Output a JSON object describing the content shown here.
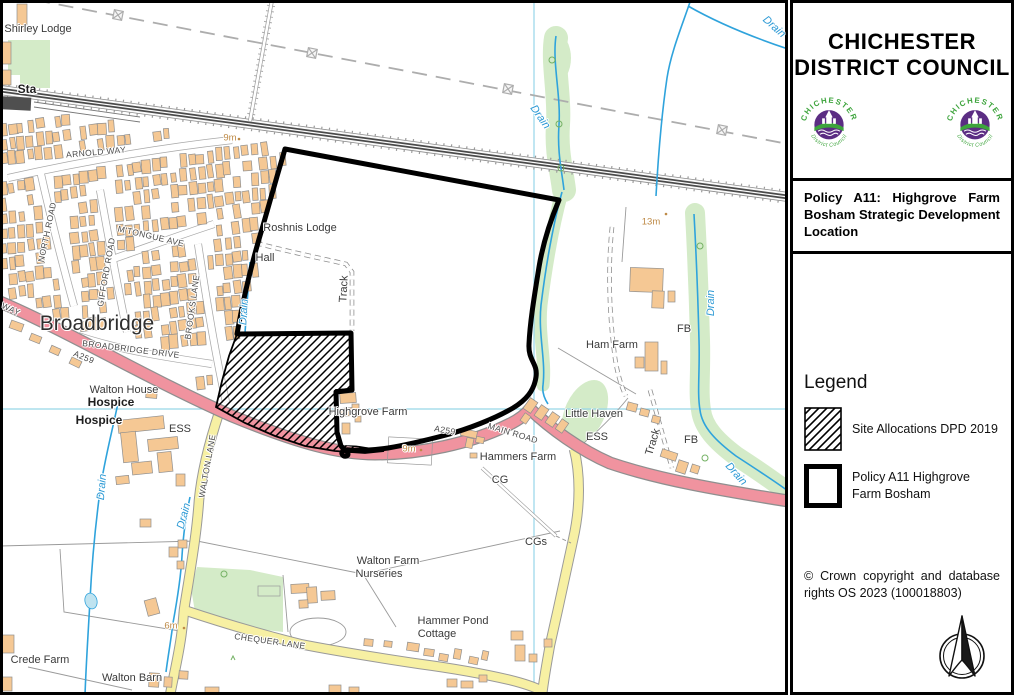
{
  "panel": {
    "title": "CHICHESTER DISTRICT COUNCIL",
    "logo": {
      "arc_top": "CHICHESTER",
      "arc_bottom": "District Council"
    },
    "policy_statement": "Policy A11: Highgrove Farm Bosham Strategic Development Location",
    "legend": {
      "heading": "Legend",
      "items": [
        {
          "id": "site-allocations",
          "swatch": "hatch",
          "label": "Site Allocations DPD 2019"
        },
        {
          "id": "policy-a11",
          "swatch": "thick-outline",
          "label": "Policy A11 Highgrove Farm Bosham"
        }
      ]
    },
    "copyright": "© Crown copyright and database rights OS 2023 (100018803)"
  },
  "map": {
    "colors": {
      "building": "#F5C894",
      "building_outline": "#8F8F8F",
      "a_road": "#F0939F",
      "minor_road": "#F7F0A3",
      "green": "#D4EBC8",
      "water": "#2FA3DC",
      "grid": "#97D6E8",
      "boundary": "#000000",
      "height_label": "#BE8A46"
    },
    "labels": [
      {
        "text": "Shirley Lodge",
        "x": 38,
        "y": 29,
        "r": 0,
        "s": "p"
      },
      {
        "text": "Sta",
        "x": 27,
        "y": 89,
        "r": 0,
        "s": "b"
      },
      {
        "text": "ARNOLD WAY",
        "x": 96,
        "y": 152,
        "r": -5,
        "s": "r"
      },
      {
        "text": "9m",
        "x": 230,
        "y": 138,
        "r": 0,
        "s": "h"
      },
      {
        "text": "NORTH ROAD",
        "x": 47,
        "y": 232,
        "r": -78,
        "s": "r"
      },
      {
        "text": "M'TONGUE AVE",
        "x": 151,
        "y": 236,
        "r": 13,
        "s": "r"
      },
      {
        "text": "GIFFORD ROAD",
        "x": 106,
        "y": 272,
        "r": -80,
        "s": "r"
      },
      {
        "text": "BROOKS LANE",
        "x": 192,
        "y": 307,
        "r": -82,
        "s": "r"
      },
      {
        "text": "Broadbridge",
        "x": 97,
        "y": 324,
        "r": 0,
        "s": "c"
      },
      {
        "text": "BROADBRIDGE DRIVE",
        "x": 131,
        "y": 349,
        "r": 7,
        "s": "r"
      },
      {
        "text": "A259",
        "x": 84,
        "y": 357,
        "r": 22,
        "s": "r"
      },
      {
        "text": "WAY",
        "x": 11,
        "y": 309,
        "r": 25,
        "s": "r"
      },
      {
        "text": "Roshnis Lodge",
        "x": 300,
        "y": 228,
        "r": 0,
        "s": "p"
      },
      {
        "text": "Hall",
        "x": 265,
        "y": 258,
        "r": 0,
        "s": "p"
      },
      {
        "text": "Track",
        "x": 344,
        "y": 289,
        "r": -87,
        "s": "p"
      },
      {
        "text": "Drain",
        "x": 244,
        "y": 312,
        "r": -87,
        "s": "w"
      },
      {
        "text": "13m",
        "x": 651,
        "y": 222,
        "r": 0,
        "s": "h"
      },
      {
        "text": "Drain",
        "x": 540,
        "y": 117,
        "r": 55,
        "s": "w"
      },
      {
        "text": "Drain",
        "x": 774,
        "y": 27,
        "r": 42,
        "s": "w"
      },
      {
        "text": "Drain",
        "x": 711,
        "y": 303,
        "r": -90,
        "s": "w"
      },
      {
        "text": "FB",
        "x": 684,
        "y": 329,
        "r": 0,
        "s": "p"
      },
      {
        "text": "Ham Farm",
        "x": 612,
        "y": 345,
        "r": 0,
        "s": "p"
      },
      {
        "text": "Little Haven",
        "x": 594,
        "y": 414,
        "r": 0,
        "s": "p"
      },
      {
        "text": "ESS",
        "x": 597,
        "y": 437,
        "r": 0,
        "s": "p"
      },
      {
        "text": "A259",
        "x": 445,
        "y": 430,
        "r": 10,
        "s": "r"
      },
      {
        "text": "MAIN ROAD",
        "x": 513,
        "y": 433,
        "r": 17,
        "s": "r"
      },
      {
        "text": "Highgrove Farm",
        "x": 368,
        "y": 412,
        "r": 0,
        "s": "p"
      },
      {
        "text": "Hammers Farm",
        "x": 518,
        "y": 457,
        "r": 0,
        "s": "p"
      },
      {
        "text": "CG",
        "x": 500,
        "y": 480,
        "r": 0,
        "s": "p"
      },
      {
        "text": "CGs",
        "x": 536,
        "y": 542,
        "r": 0,
        "s": "p"
      },
      {
        "text": "9m",
        "x": 409,
        "y": 449,
        "r": 0,
        "s": "h"
      },
      {
        "text": "Track",
        "x": 653,
        "y": 442,
        "r": -73,
        "s": "p"
      },
      {
        "text": "FB",
        "x": 691,
        "y": 440,
        "r": 0,
        "s": "p"
      },
      {
        "text": "Drain",
        "x": 736,
        "y": 474,
        "r": 48,
        "s": "w"
      },
      {
        "text": "Walton House",
        "x": 124,
        "y": 390,
        "r": 0,
        "s": "p"
      },
      {
        "text": "Hospice",
        "x": 111,
        "y": 402,
        "r": 0,
        "s": "b"
      },
      {
        "text": "Hospice",
        "x": 99,
        "y": 420,
        "r": 0,
        "s": "b"
      },
      {
        "text": "ESS",
        "x": 180,
        "y": 429,
        "r": 0,
        "s": "p"
      },
      {
        "text": "WALTON LANE",
        "x": 207,
        "y": 466,
        "r": -80,
        "s": "r"
      },
      {
        "text": "Drain",
        "x": 102,
        "y": 487,
        "r": -85,
        "s": "w"
      },
      {
        "text": "Drain",
        "x": 184,
        "y": 516,
        "r": -75,
        "s": "w"
      },
      {
        "text": "Walton Farm",
        "x": 388,
        "y": 561,
        "r": 0,
        "s": "p"
      },
      {
        "text": "Nurseries",
        "x": 379,
        "y": 574,
        "r": 0,
        "s": "p"
      },
      {
        "text": "Hammer Pond",
        "x": 453,
        "y": 621,
        "r": 0,
        "s": "p"
      },
      {
        "text": "Cottage",
        "x": 437,
        "y": 634,
        "r": 0,
        "s": "p"
      },
      {
        "text": "Crede Farm",
        "x": 40,
        "y": 660,
        "r": 0,
        "s": "p"
      },
      {
        "text": "Walton Barn",
        "x": 132,
        "y": 678,
        "r": 0,
        "s": "p"
      },
      {
        "text": "6m",
        "x": 171,
        "y": 626,
        "r": 0,
        "s": "h"
      },
      {
        "text": "CHEQUER LANE",
        "x": 270,
        "y": 641,
        "r": 8,
        "s": "r"
      }
    ]
  }
}
